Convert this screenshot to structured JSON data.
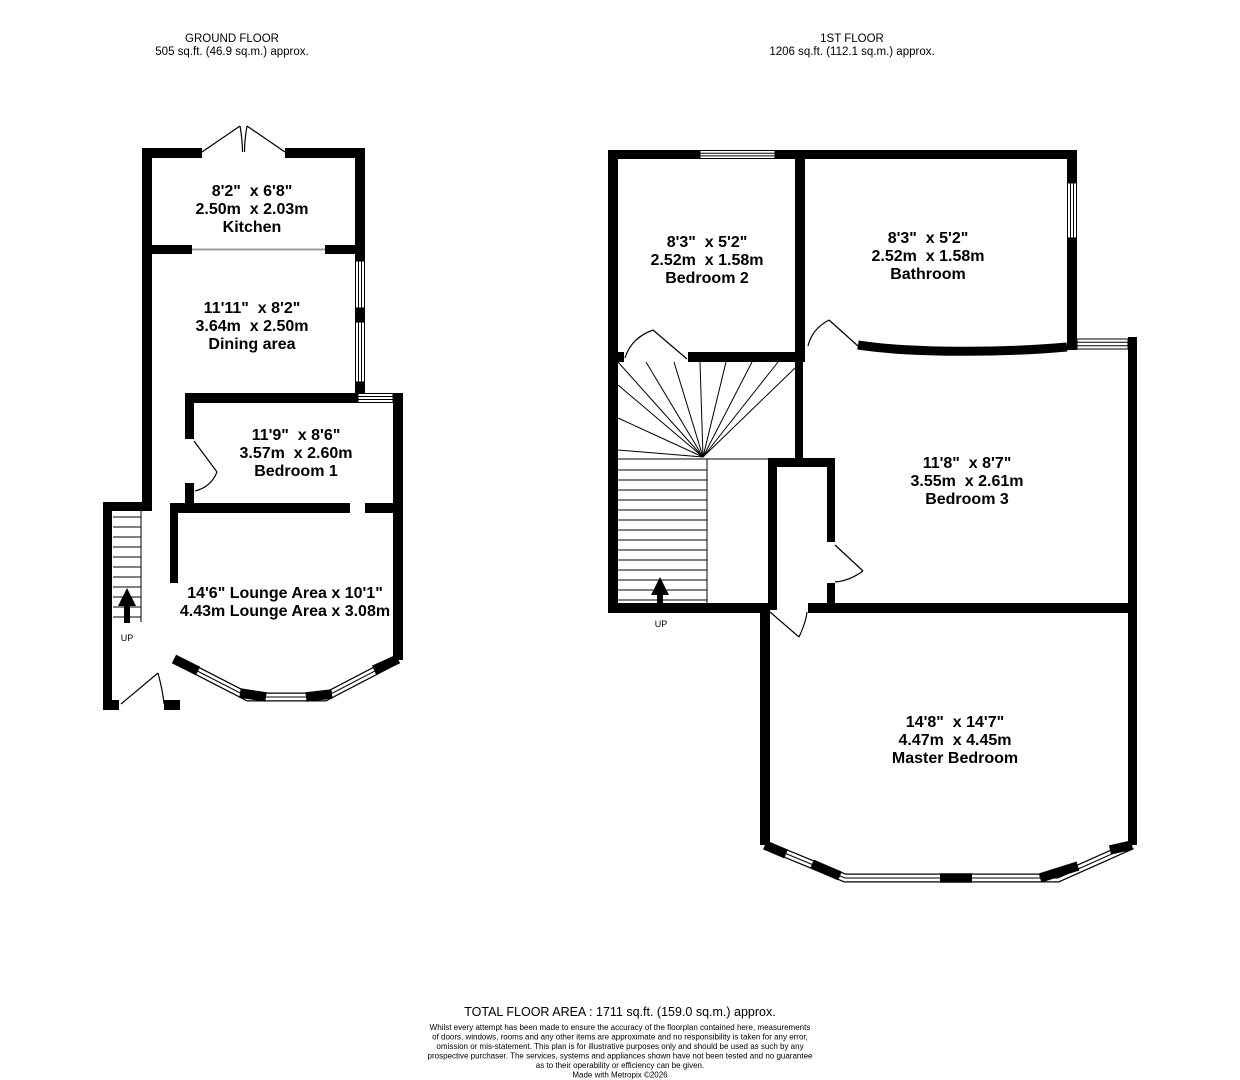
{
  "ground_floor": {
    "title": "GROUND FLOOR",
    "area": "505 sq.ft. (46.9 sq.m.) approx.",
    "stairs_label": "UP",
    "rooms": {
      "kitchen": {
        "dims_imperial": "8'2\"  x 6'8\"",
        "dims_metric": "2.50m  x 2.03m",
        "name": "Kitchen"
      },
      "dining": {
        "dims_imperial": "11'11\"  x 8'2\"",
        "dims_metric": "3.64m  x 2.50m",
        "name": "Dining area"
      },
      "bedroom1": {
        "dims_imperial": "11'9\"  x 8'6\"",
        "dims_metric": "3.57m  x 2.60m",
        "name": "Bedroom 1"
      },
      "lounge": {
        "line1": "14'6\" Lounge Area x 10'1\"",
        "line2": "4.43m Lounge Area x 3.08m"
      }
    }
  },
  "first_floor": {
    "title": "1ST FLOOR",
    "area": "1206 sq.ft. (112.1 sq.m.) approx.",
    "stairs_label": "UP",
    "rooms": {
      "bedroom2": {
        "dims_imperial": "8'3\"  x 5'2\"",
        "dims_metric": "2.52m  x 1.58m",
        "name": "Bedroom 2"
      },
      "bathroom": {
        "dims_imperial": "8'3\"  x 5'2\"",
        "dims_metric": "2.52m  x 1.58m",
        "name": "Bathroom"
      },
      "bedroom3": {
        "dims_imperial": "11'8\"  x 8'7\"",
        "dims_metric": "3.55m  x 2.61m",
        "name": "Bedroom 3"
      },
      "master": {
        "dims_imperial": "14'8\"  x 14'7\"",
        "dims_metric": "4.47m  x 4.45m",
        "name": "Master Bedroom"
      }
    }
  },
  "footer": {
    "total": "TOTAL FLOOR AREA : 1711 sq.ft. (159.0 sq.m.) approx.",
    "disclaimer_lines": [
      "Whilst every attempt has been made to ensure the accuracy of the floorplan contained here, measurements",
      "of doors, windows, rooms and any other items are approximate and no responsibility is taken for any error,",
      "omission or mis-statement. This plan is for illustrative purposes only and should be used as such by any",
      "prospective purchaser. The services, systems and appliances shown have not been tested and no guarantee",
      "as to their operability or efficiency can be given."
    ],
    "credit": "Made with Metropix ©2026"
  },
  "colors": {
    "wall": "#000000",
    "background": "#ffffff",
    "open_divider": "#9a9a9a"
  }
}
